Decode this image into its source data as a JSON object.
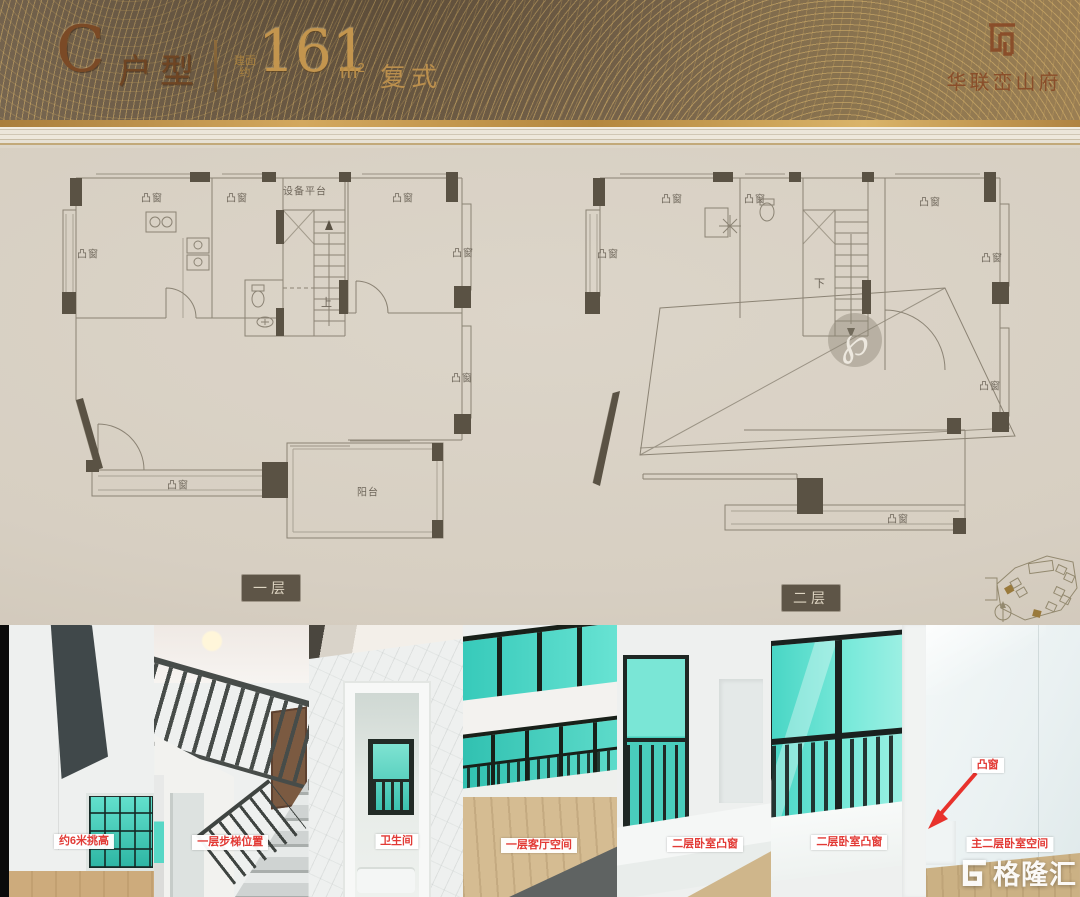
{
  "header": {
    "unit_letter": "C",
    "unit_type_label": "户型",
    "area_prefix": "建面约",
    "area_value": "161",
    "area_unit": "m²",
    "duplex_label": "复式",
    "brand_name": "华联峦山府"
  },
  "plans": {
    "bay_window_label": "凸窗",
    "balcony_label": "阳台",
    "equipment_platform_label": "设备平台",
    "stairs_up_label": "上",
    "stairs_down_label": "下",
    "floor1_name": "一层",
    "floor2_name": "二层",
    "stamp_glyph": "℘"
  },
  "photos": [
    {
      "label": "约6米挑高"
    },
    {
      "label": "一层步梯位置"
    },
    {
      "label": "卫生间"
    },
    {
      "label": "一层客厅空间"
    },
    {
      "label": "二层卧室凸窗"
    },
    {
      "label": "二层卧室凸窗"
    },
    {
      "label": "主二层卧室空间",
      "callout": "凸窗"
    }
  ],
  "watermark": {
    "brand_text": "格隆汇"
  },
  "icons": {
    "brand_monogram": "square-w-monogram",
    "gelonghui_logo": "blocky-g",
    "compass": "north-compass",
    "plan_stamp": "script-p-seal"
  },
  "colors": {
    "gold_band": "#76634a",
    "gold_text": "#c3954e",
    "title_bronze": "#7b4a26",
    "paper": "#d7cfc2",
    "plan_line": "#8b8374",
    "plan_wall": "#5a5244",
    "badge_bg": "#5e5547",
    "label_red": "#e23a35",
    "teal_glass": "#49d6c5",
    "wood_floor": "#cdb184"
  }
}
